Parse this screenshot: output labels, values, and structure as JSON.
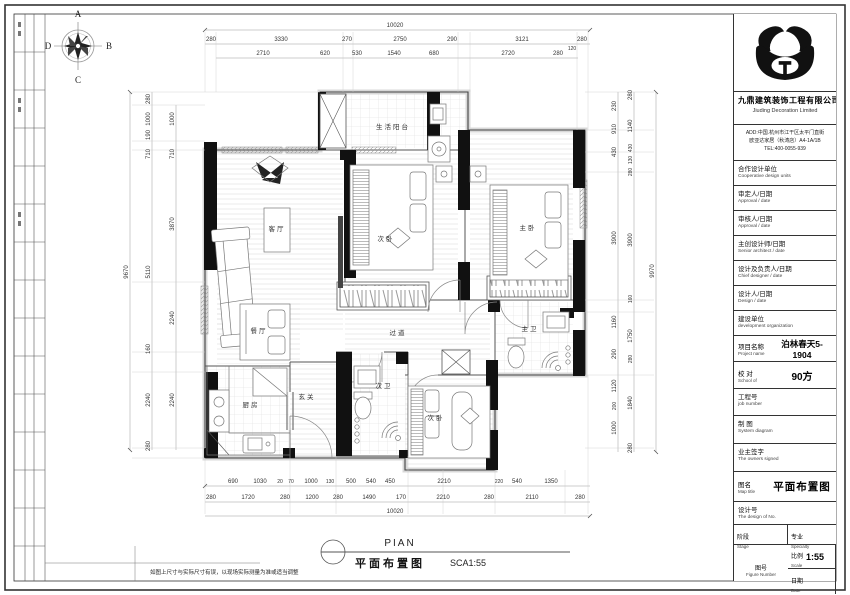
{
  "compass": {
    "n": "A",
    "e": "B",
    "s": "C",
    "w": "D"
  },
  "rooms": {
    "balcony": "生活阳台",
    "living": "客厅",
    "bedroom2": "次卧",
    "master": "主卧",
    "dining": "餐厅",
    "corridor": "过道",
    "kitchen": "厨房",
    "entry": "玄关",
    "bath2": "次卫",
    "bedroom3": "次卧",
    "master_bath": "主卫"
  },
  "dims": {
    "top_total": "10020",
    "top1": [
      "280",
      "3330",
      "270",
      "2750",
      "290",
      "3121",
      "280",
      "120"
    ],
    "top2": [
      "2710",
      "620",
      "530",
      "1540",
      "680",
      "2720",
      "280"
    ],
    "bottom1": [
      "690",
      "1030",
      "20",
      "70",
      "1000",
      "130",
      "500",
      "540",
      "450",
      "2210",
      "220",
      "540",
      "1350"
    ],
    "bottom2": [
      "280",
      "1720",
      "280",
      "1200",
      "280",
      "1490",
      "170",
      "2210",
      "280",
      "2110",
      "280"
    ],
    "bottom_total": "10020",
    "left_total": "9670",
    "left1": [
      "280",
      "1000",
      "190",
      "710",
      "5110",
      "160",
      "2240",
      "280"
    ],
    "left2": [
      "1000",
      "710",
      "3870",
      "2240",
      "2240"
    ],
    "right_total": "9970",
    "right1": [
      "230",
      "910",
      "430",
      "3900",
      "1160",
      "290",
      "1120",
      "200",
      "1000"
    ],
    "right2": [
      "280",
      "1140",
      "430",
      "130",
      "280",
      "3900",
      "160",
      "1750",
      "280",
      "1840",
      "280"
    ]
  },
  "titleblock": {
    "company_cn": "九鼎建筑装饰工程有限公司",
    "company_en": "Jiuding Decoration Limited",
    "address1": "ADD:中国.杭州市江干区太平门直街",
    "address2": "欧亚达家居（秋涛店）A4-1A/1B",
    "tel": "TEL:400-0055-939",
    "rows": [
      {
        "cn": "合作设计单位",
        "en": "Cooperative design units"
      },
      {
        "cn": "审定人/日期",
        "en": "Approval / date"
      },
      {
        "cn": "审核人/日期",
        "en": "Approval / date"
      },
      {
        "cn": "主创设计师/日期",
        "en": "Senior architect / date"
      },
      {
        "cn": "设计及负责人/日期",
        "en": "Chief designer / date"
      },
      {
        "cn": "设计人/日期",
        "en": "Design / date"
      },
      {
        "cn": "建设单位",
        "en": "development organization"
      }
    ],
    "project": {
      "cn": "项目名称",
      "en": "Project name",
      "value": "泊林春天5-1904"
    },
    "proof": {
      "cn": "校 对",
      "en": "School of",
      "value": "90方"
    },
    "job": {
      "cn": "工程号",
      "en": "job number"
    },
    "system": {
      "cn": "制 图",
      "en": "System diagram"
    },
    "owner": {
      "cn": "业主签字",
      "en": "The owners signed"
    },
    "map": {
      "cn": "图名",
      "en": "Map title",
      "value": "平面布置图"
    },
    "designno": {
      "cn": "设计号",
      "en": "The design of No."
    },
    "stage": {
      "cn": "阶段",
      "en": "Stage"
    },
    "specialty": {
      "cn": "专业",
      "en": "Specialty"
    },
    "scale": {
      "cn": "比例",
      "en": "Scale",
      "value": "1:55"
    },
    "figure": {
      "cn": "图号",
      "en": "Figure Number"
    },
    "date": {
      "cn": "日期",
      "en": "Date"
    }
  },
  "footer": {
    "code": "PIAN",
    "title": "平面布置图",
    "scale": "SCA1:55"
  },
  "note": "如图上尺寸与实际尺寸有误，以现场实际测量为准或适当调整"
}
